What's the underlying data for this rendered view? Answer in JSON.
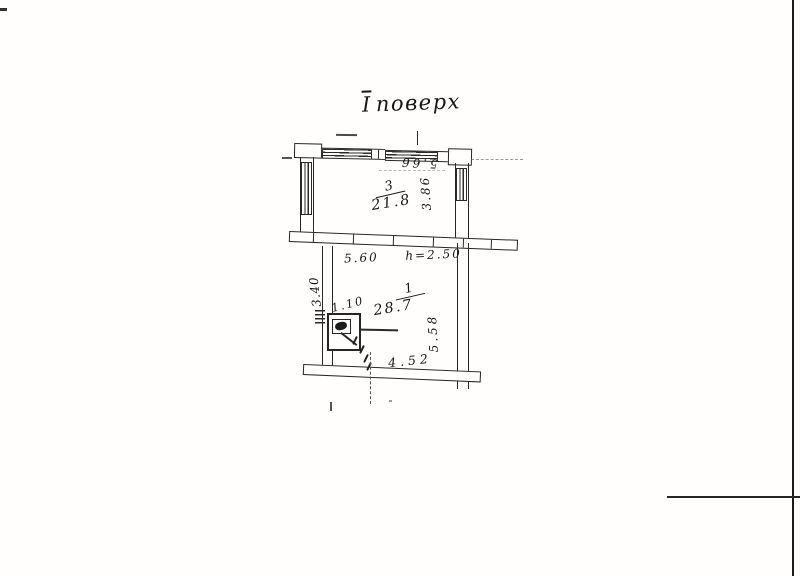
{
  "title": {
    "numeral": "І",
    "word": "поверх"
  },
  "rooms": [
    {
      "number": "3",
      "area": "21.8"
    },
    {
      "number": "1",
      "area": "28.7"
    }
  ],
  "dims": {
    "room3_top": "5.66",
    "room3_side": "3.86",
    "room1_top": "5.60",
    "room1_height": "h=2.50",
    "room1_left": "3.40",
    "room1_door": "1.10",
    "room1_right": "5.58",
    "room1_bottom": "4.52"
  },
  "colors": {
    "paper": "#fffefd",
    "ink": "#262626"
  }
}
